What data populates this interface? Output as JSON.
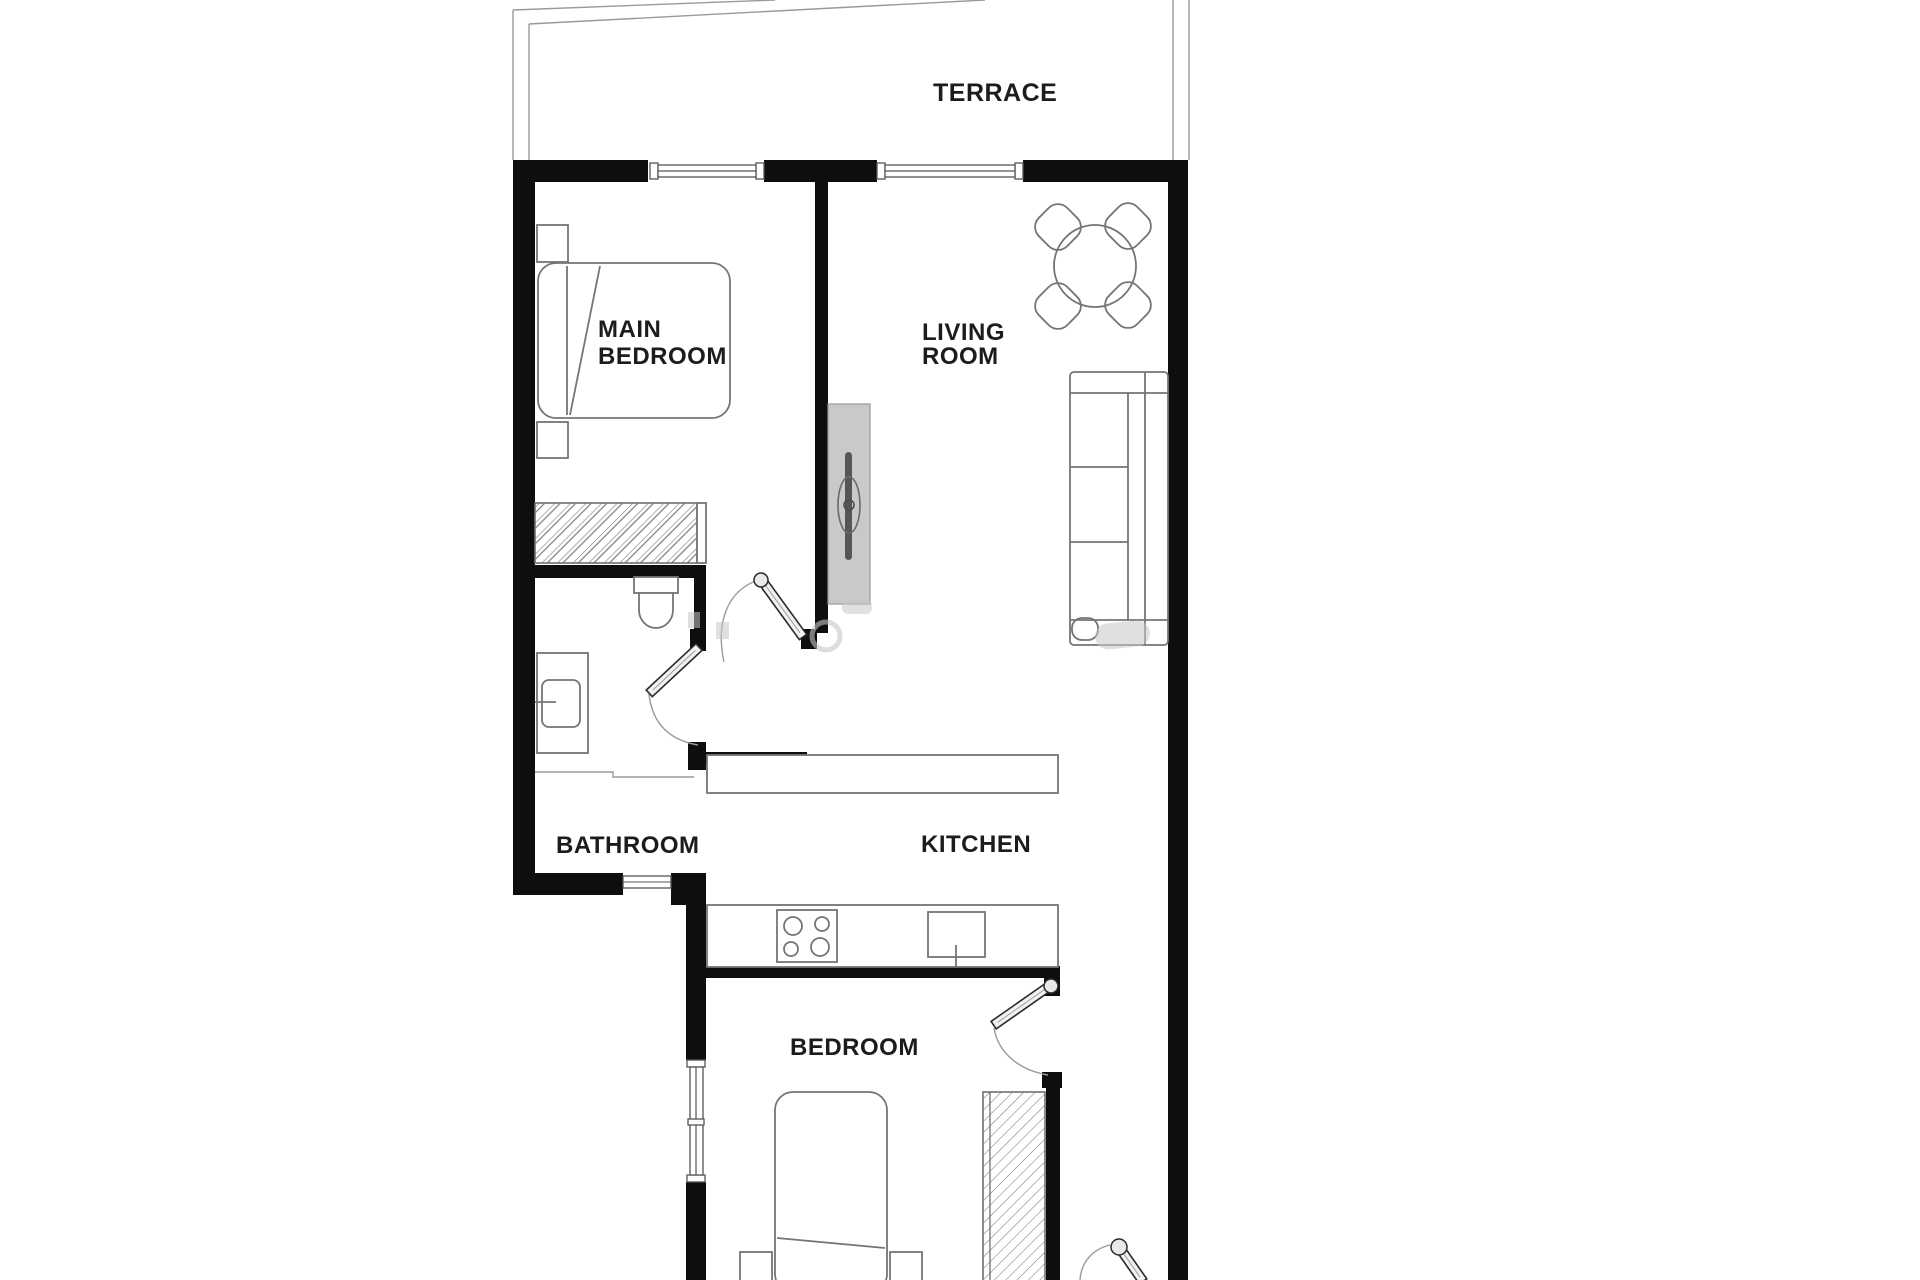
{
  "meta": {
    "title": "Apartment floor plan"
  },
  "colors": {
    "background": "#ffffff",
    "wall": "#0e0e0e",
    "furniture_line": "#757575",
    "thin_line": "#9a9a9a",
    "gray_unit": "#c9c9c9",
    "text": "#1c1c1c",
    "watermark": "#c6c6c6"
  },
  "labels": {
    "terrace": "TERRACE",
    "main_bedroom": [
      "MAIN",
      "BEDROOM"
    ],
    "living_room": [
      "LIVING",
      "ROOM"
    ],
    "bathroom": "BATHROOM",
    "kitchen": "KITCHEN",
    "bedroom": "BEDROOM"
  }
}
